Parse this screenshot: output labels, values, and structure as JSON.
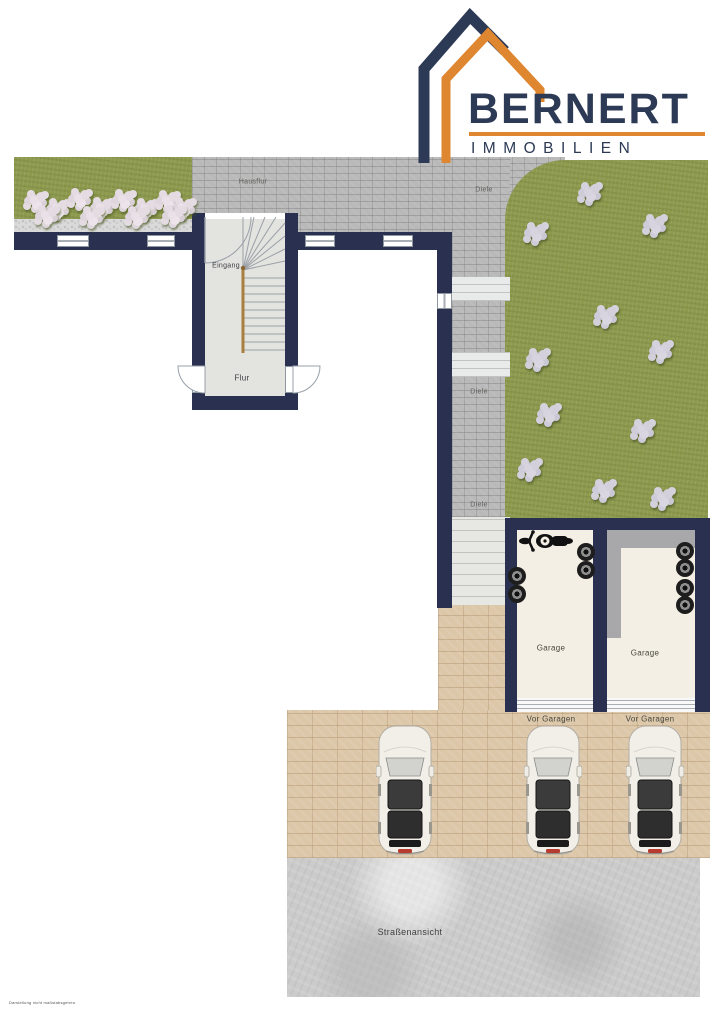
{
  "logo": {
    "brand": "BERNERT",
    "subtitle": "IMMOBILIEN"
  },
  "labels": {
    "hausflur": "Hausflur",
    "eingang": "Eingang",
    "flur": "Flur",
    "diele": "Diele",
    "garage": "Garage",
    "vor_garagen": "Vor Garagen",
    "strassenansicht": "Straßenansicht",
    "disclaimer": "Darstellung nicht maßstabsgetreu"
  },
  "colors": {
    "wall_navy": "#2a3150",
    "logo_navy": "#2c3a55",
    "logo_orange": "#df8630",
    "lawn_green": "#8e9b4f",
    "paving_gray": "#b9b9b9",
    "paving_tan": "#dcc7a9",
    "concrete_gray": "#cbcbcb",
    "garage_floor": "#f4efe4",
    "handrail_brown": "#a87f3e"
  },
  "plan": {
    "diele_labels": [
      {
        "x": 484,
        "y": 190
      },
      {
        "x": 479,
        "y": 392
      },
      {
        "x": 479,
        "y": 505
      }
    ],
    "lawn_bushes": [
      [
        588,
        192
      ],
      [
        534,
        232
      ],
      [
        653,
        224
      ],
      [
        604,
        315
      ],
      [
        536,
        358
      ],
      [
        659,
        350
      ],
      [
        547,
        413
      ],
      [
        641,
        429
      ],
      [
        528,
        468
      ],
      [
        602,
        489
      ],
      [
        661,
        497
      ]
    ],
    "garden_flowers": [
      [
        34,
        200
      ],
      [
        56,
        208
      ],
      [
        78,
        198
      ],
      [
        100,
        207
      ],
      [
        122,
        199
      ],
      [
        144,
        208
      ],
      [
        166,
        200
      ],
      [
        182,
        207
      ],
      [
        45,
        215
      ],
      [
        90,
        216
      ],
      [
        135,
        216
      ],
      [
        172,
        215
      ]
    ],
    "tires": [
      [
        586,
        552
      ],
      [
        586,
        570
      ],
      [
        517,
        576
      ],
      [
        517,
        594
      ],
      [
        685,
        551
      ],
      [
        685,
        568
      ],
      [
        685,
        588
      ],
      [
        685,
        605
      ]
    ],
    "cars": [
      {
        "x": 405
      },
      {
        "x": 553
      },
      {
        "x": 655
      }
    ]
  }
}
